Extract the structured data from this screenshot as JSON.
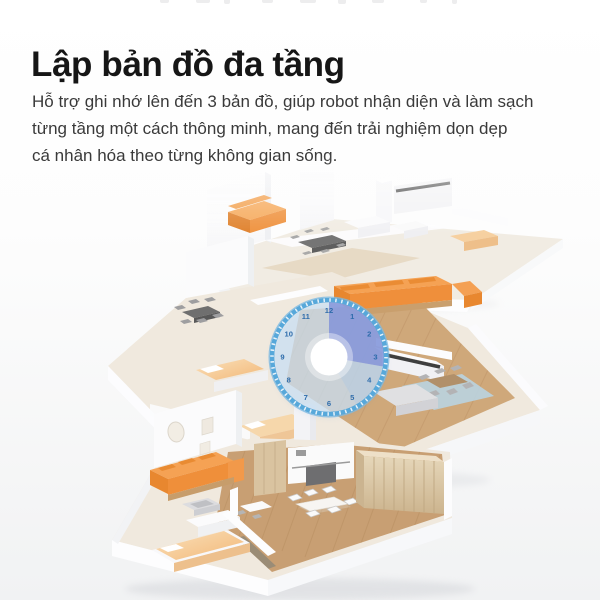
{
  "page": {
    "background_top": "#ffffff",
    "background_bottom": "#f1f2f3"
  },
  "header": {
    "title": "Lập bản đồ đa tầng",
    "description_lines": [
      "Hỗ trợ ghi nhớ lên đến 3 bản đồ, giúp robot nhận diện và làm sạch",
      "từng tầng một cách thông minh, mang đến trải nghiệm dọn dẹp",
      "cá nhân hóa theo từng không gian sống."
    ]
  },
  "illustration": {
    "clock": {
      "numbers": [
        "12",
        "1",
        "2",
        "3",
        "4",
        "5",
        "6",
        "7",
        "8",
        "9",
        "10",
        "11"
      ],
      "rim_color": "#57a8da",
      "face_color": "#cfe3f5",
      "sector_color": "#7e90d8",
      "number_color": "#2e6cab",
      "center_color": "#ffffff"
    },
    "floor_colors": {
      "sofa_orange": "#f09a44",
      "bed_tan": "#f6d2a2",
      "wood_floor": "#cda67c",
      "wood_cabinet": "#d8c5a3",
      "rug_blue": "#b9d6e6",
      "wall_white": "#fbfbfc"
    }
  }
}
